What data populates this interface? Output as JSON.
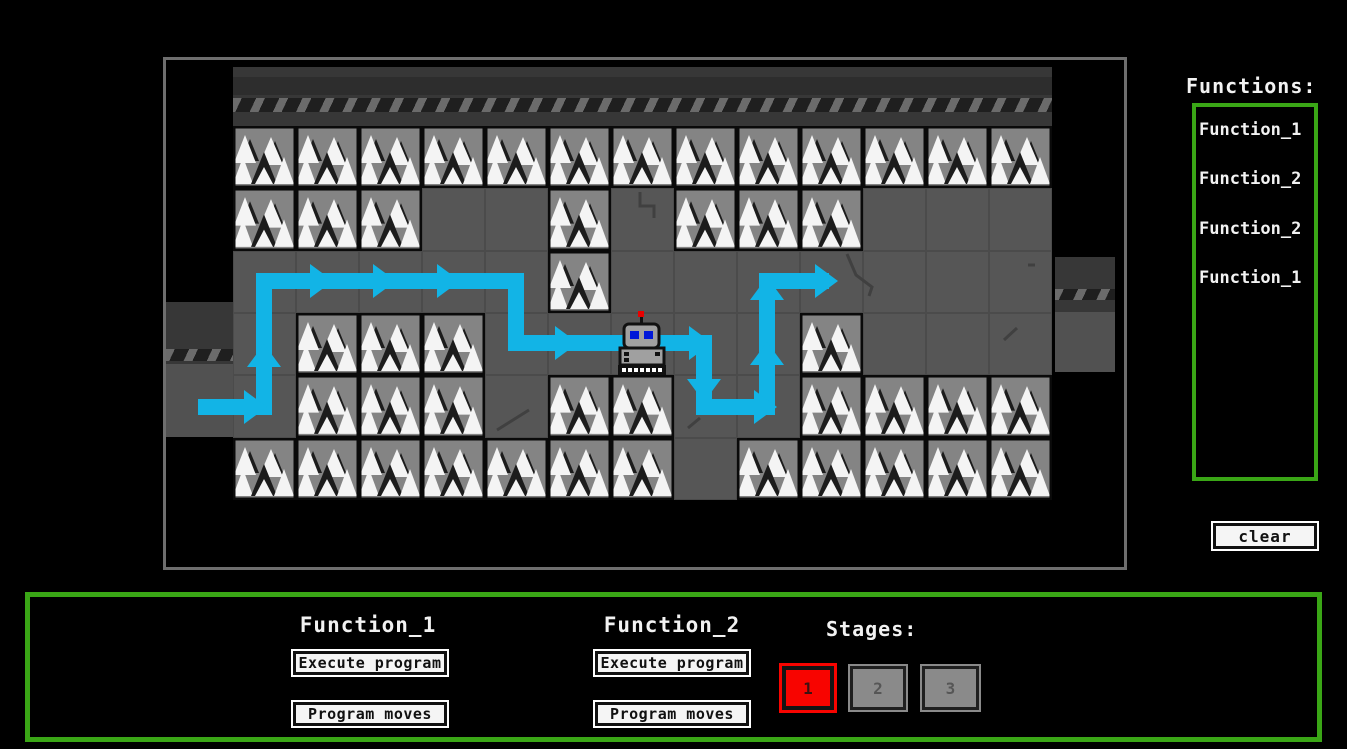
{
  "map": {
    "tiles": [
      "TTTTTTTTTTTTT",
      "TTTGGTGTTTGGG",
      "GGGGGTGGGGGGG",
      "GTTTGGGGGTGGG",
      "GTTTGTTGGTTTT",
      "TTTTTTTGTTTTT"
    ],
    "robot": {
      "col": 6,
      "row": 3
    },
    "path_color": "#12b4e6",
    "path_points": [
      [
        32,
        347
      ],
      [
        98,
        347
      ],
      [
        98,
        221
      ],
      [
        350,
        221
      ],
      [
        350,
        283
      ],
      [
        538,
        283
      ],
      [
        538,
        347
      ],
      [
        601,
        347
      ],
      [
        601,
        221
      ],
      [
        663,
        221
      ]
    ],
    "arrows": [
      {
        "x": 101,
        "y": 347,
        "dir": "right"
      },
      {
        "x": 98,
        "y": 284,
        "dir": "up"
      },
      {
        "x": 167,
        "y": 221,
        "dir": "right"
      },
      {
        "x": 230,
        "y": 221,
        "dir": "right"
      },
      {
        "x": 294,
        "y": 221,
        "dir": "right"
      },
      {
        "x": 412,
        "y": 283,
        "dir": "right"
      },
      {
        "x": 546,
        "y": 283,
        "dir": "right"
      },
      {
        "x": 538,
        "y": 342,
        "dir": "down"
      },
      {
        "x": 611,
        "y": 347,
        "dir": "right"
      },
      {
        "x": 601,
        "y": 282,
        "dir": "up"
      },
      {
        "x": 601,
        "y": 217,
        "dir": "up"
      },
      {
        "x": 672,
        "y": 221,
        "dir": "right"
      }
    ],
    "cracks": [
      [
        [
          474,
          132
        ],
        [
          474,
          146
        ],
        [
          488,
          146
        ],
        [
          488,
          158
        ]
      ],
      [
        [
          681,
          194
        ],
        [
          690,
          215
        ],
        [
          706,
          227
        ],
        [
          703,
          236
        ]
      ],
      [
        [
          838,
          280
        ],
        [
          851,
          268
        ]
      ],
      [
        [
          331,
          370
        ],
        [
          363,
          350
        ]
      ],
      [
        [
          522,
          368
        ],
        [
          534,
          358
        ]
      ],
      [
        [
          862,
          205
        ],
        [
          869,
          205
        ]
      ]
    ]
  },
  "functions_panel": {
    "title": "Functions:",
    "items": [
      "Function_1",
      "Function_2",
      "Function_2",
      "Function_1"
    ]
  },
  "clear_label": "clear",
  "bottom": {
    "fn1": {
      "title": "Function_1",
      "execute": "Execute program",
      "moves": "Program moves"
    },
    "fn2": {
      "title": "Function_2",
      "execute": "Execute program",
      "moves": "Program moves"
    },
    "stages": {
      "title": "Stages:",
      "items": [
        {
          "label": "1",
          "active": true
        },
        {
          "label": "2",
          "active": false
        },
        {
          "label": "3",
          "active": false
        }
      ]
    }
  },
  "colors": {
    "panel_green": "#3aa616",
    "stage_active_red": "#f80400",
    "stage_inactive_gray": "#8a8a8a",
    "path_cyan": "#12b4e6",
    "ground_gray": "#565656",
    "tree_tile_gray": "#848484"
  }
}
